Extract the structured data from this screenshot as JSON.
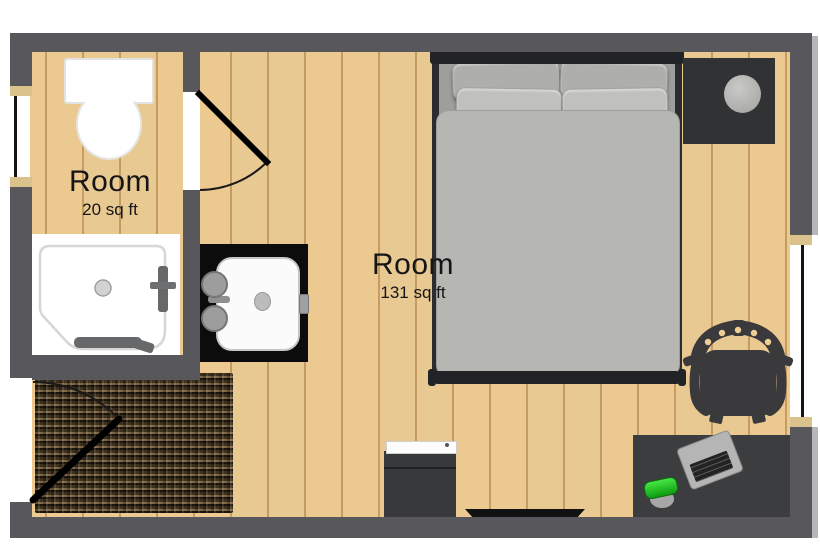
{
  "plan": {
    "rooms": [
      {
        "label": "Room",
        "area": "20 sq ft"
      },
      {
        "label": "Room",
        "area": "131 sq ft"
      }
    ],
    "furniture_icons": [
      "toilet-icon",
      "shower-icon",
      "sink-vanity-icon",
      "bed-icon",
      "nightstand-icon",
      "lamp-icon",
      "tv-icon",
      "dresser-icon",
      "door-mat-icon",
      "desk-icon",
      "office-chair-icon",
      "laptop-icon",
      "mug-icon",
      "door-swing-icon",
      "window-icon"
    ],
    "colors": {
      "wall": "#58585c",
      "floor": "#f0cf97",
      "plank_line": "#a9763a",
      "bed_duvet": "#b6b6b3",
      "bed_frame": "#232428",
      "pillow": "#b9b9b6",
      "furniture_dark": "#3a3b3d",
      "counter_black": "#0c0c0c",
      "mat_brown": "#5e4e36",
      "lamp_gray": "#b3b3b1",
      "mug_green": "#2ecc2e",
      "window_cap_tan": "#d9c28c",
      "window_glass": "#141414",
      "fixture_white": "#ffffff"
    }
  }
}
